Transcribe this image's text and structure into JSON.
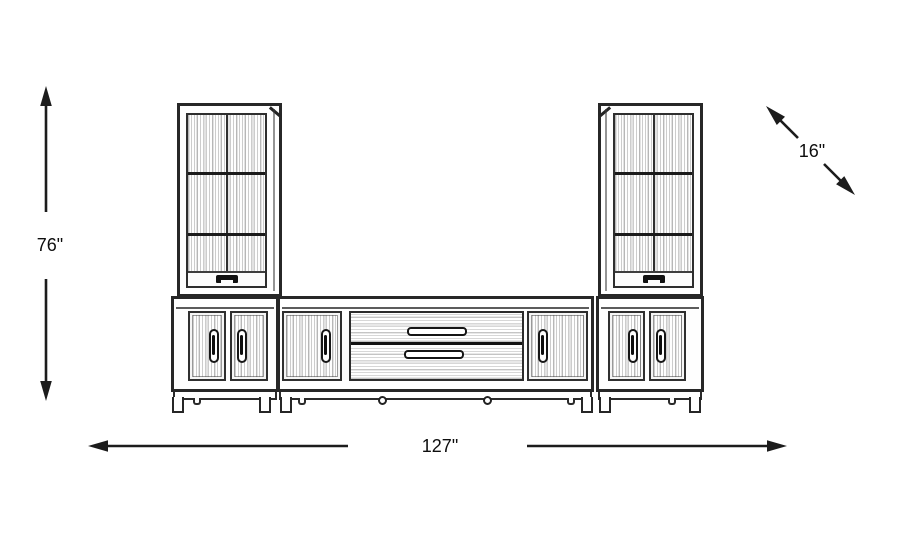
{
  "illustration": {
    "name": "entertainment-wall-unit-line-drawing"
  },
  "dimensions": {
    "height": {
      "label": "76\"",
      "value": 76,
      "unit": "inches",
      "orientation": "vertical"
    },
    "width": {
      "label": "127\"",
      "value": 127,
      "unit": "inches",
      "orientation": "horizontal"
    },
    "depth": {
      "label": "16\"",
      "value": 16,
      "unit": "inches",
      "orientation": "diagonal"
    }
  },
  "colors": {
    "background": "#ffffff",
    "line": "#1c1c1c",
    "text": "#0e0e0e"
  }
}
